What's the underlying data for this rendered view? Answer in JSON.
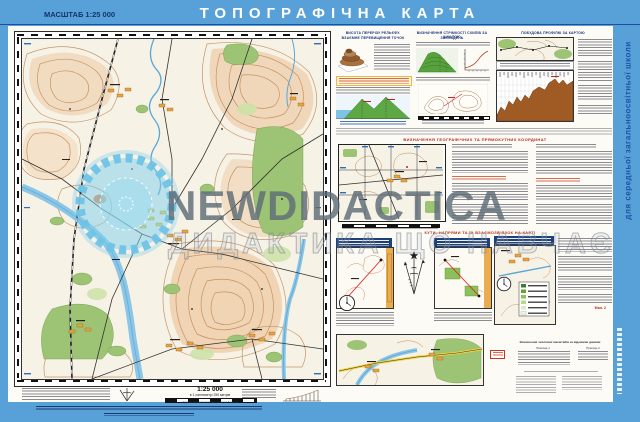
{
  "colors": {
    "page_blue": "#58a1d8",
    "navy_rule": "#1d4f9e",
    "title_white": "#ffffff",
    "scale_navy": "#13336b",
    "red_heading": "#c22310",
    "panel_title_blue": "#16337c",
    "watermark_gray": "#6c7b86"
  },
  "header": {
    "scale_label": "МАСШТАБ 1:25 000",
    "title": "ТОПОГРАФІЧНА КАРТА"
  },
  "side_strip": {
    "vertical_text": "для середньої загальноосвітньої школи"
  },
  "watermark": {
    "brand": "NEWDIDACTICA",
    "tagline": "ДИДАКТИКА ЩО НАВЧАЄ"
  },
  "map_footer": {
    "scale_title": "1:25 000",
    "scale_caption": "в 1 сантиметрі 250 метрів",
    "contour_note": "Суцільні горизонталі проведені через 5 метрів"
  },
  "panels": {
    "p1_title_line1": "ВИСОТА ПЕРЕРІЗУ РЕЛЬЄФУ.",
    "p1_title_line2": "ВЗАЄМНЕ ПЕРЕВИЩЕННЯ ТОЧОК",
    "p2_title_line1": "ВИЗНАЧЕННЯ СТРІМКОСТІ СХИЛІВ ЗА ШКАЛОЮ",
    "p2_title_line2": "ЗАКЛАДЕНЬ",
    "p3_title": "ПОБУДОВА ПРОФІЛЮ ЗА КАРТОЮ",
    "coords_title": "ВИЗНАЧЕННЯ ГЕОГРАФІЧНИХ ТА ПРЯМОКУТНИХ КООРДИНАТ",
    "angles_title": "КУТИ, НАПРЯМИ ТА ЇХ ВЗАЄМОЗВ'ЯЗОК НА КАРТІ"
  },
  "bottom_block": {
    "examples_title": "Визначення числових масштабів за відомими даними",
    "example1_label": "Приклад 1",
    "example2_label": "Приклад 2",
    "figure_label": "Мал. 2"
  }
}
